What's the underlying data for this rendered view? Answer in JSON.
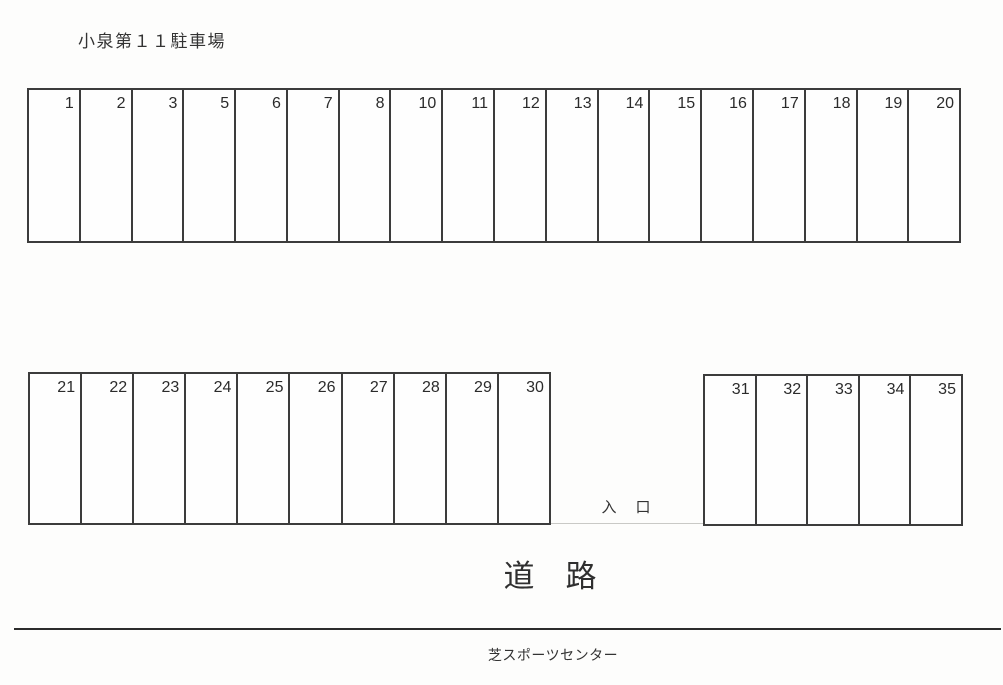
{
  "title": "小泉第１１駐車場",
  "rows": {
    "top": {
      "spaces": [
        "1",
        "2",
        "3",
        "5",
        "6",
        "7",
        "8",
        "10",
        "11",
        "12",
        "13",
        "14",
        "15",
        "16",
        "17",
        "18",
        "19",
        "20"
      ]
    },
    "bottom_left": {
      "spaces": [
        "21",
        "22",
        "23",
        "24",
        "25",
        "26",
        "27",
        "28",
        "29",
        "30"
      ]
    },
    "bottom_right": {
      "spaces": [
        "31",
        "32",
        "33",
        "34",
        "35"
      ]
    }
  },
  "labels": {
    "entrance": "入　口",
    "road": "道　路",
    "landmark": "芝スポーツセンター"
  },
  "colors": {
    "line": "#3c3c3c",
    "road_line": "#2c2c2c",
    "background": "#fdfdfc",
    "text": "#2e2e2e"
  }
}
